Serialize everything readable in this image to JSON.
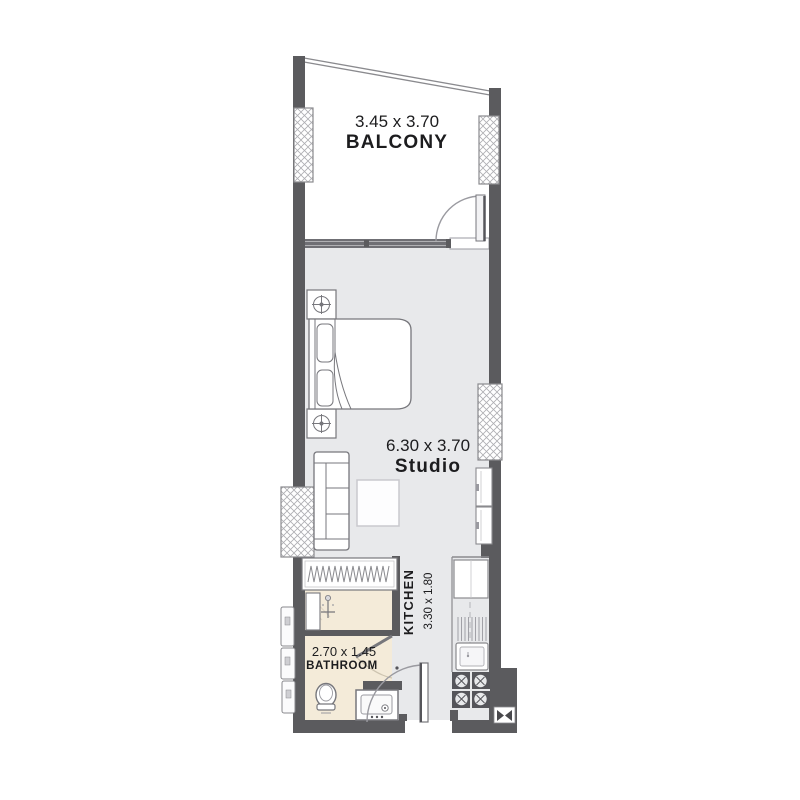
{
  "plan": {
    "balcony": {
      "dimensions": "3.45 x 3.70",
      "label": "BALCONY"
    },
    "studio": {
      "dimensions": "6.30 x 3.70",
      "label": "Studio"
    },
    "bathroom": {
      "dimensions": "2.70 x 1.45",
      "label": "BATHROOM"
    },
    "kitchen": {
      "dimensions": "3.30 x 1.80",
      "label": "KITCHEN"
    }
  },
  "colors": {
    "wall": "#5b5b5e",
    "floor": "#e8e9eb",
    "bathroom_floor": "#f4ebd9",
    "balcony_floor": "#ffffff",
    "fixture_outline": "#77777c",
    "hatch_line": "#aeaeb2",
    "text": "#1c1c1e"
  }
}
